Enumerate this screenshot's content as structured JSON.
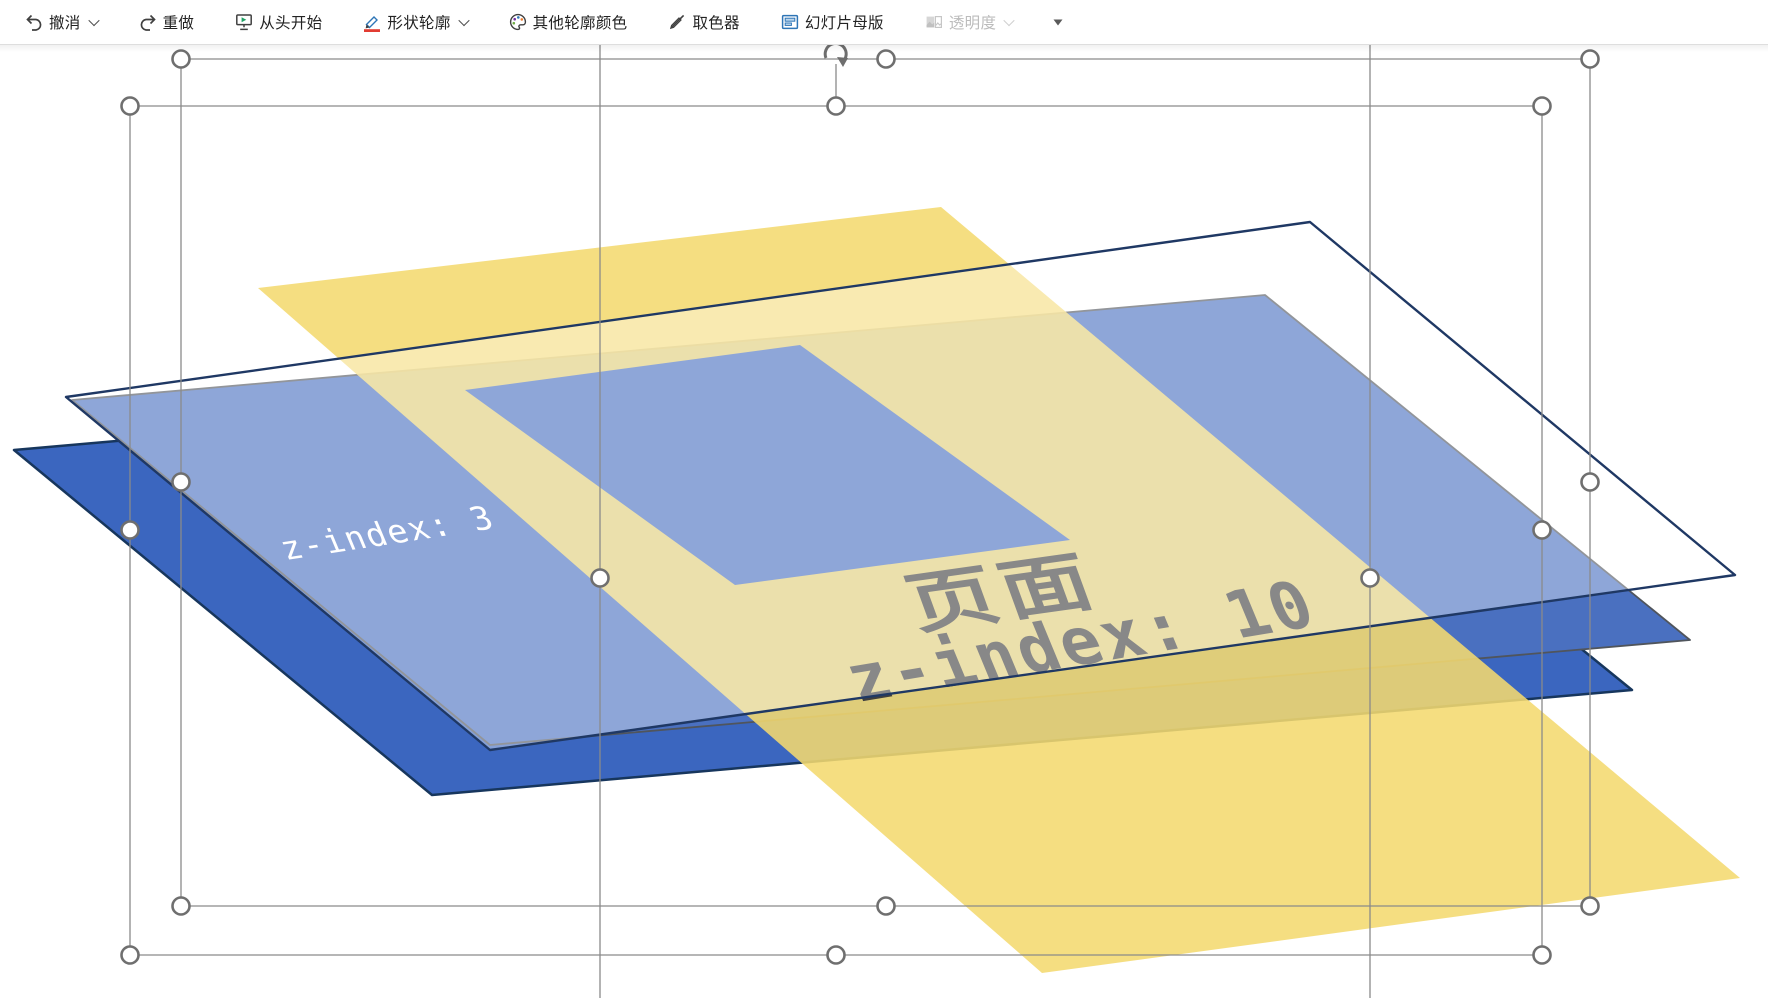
{
  "toolbar": {
    "items": [
      {
        "label": "撤消",
        "icon": "undo-icon",
        "dropdown": true,
        "disabled": false
      },
      {
        "label": "重做",
        "icon": "redo-icon",
        "dropdown": false,
        "disabled": false
      },
      {
        "label": "从头开始",
        "icon": "present-from-start-icon",
        "dropdown": false,
        "disabled": false
      },
      {
        "label": "形状轮廓",
        "icon": "shape-outline-pencil-icon",
        "dropdown": true,
        "disabled": false,
        "accent_color": "#e23c32"
      },
      {
        "label": "其他轮廓颜色",
        "icon": "palette-icon",
        "dropdown": false,
        "disabled": false
      },
      {
        "label": "取色器",
        "icon": "eyedropper-icon",
        "dropdown": false,
        "disabled": false
      },
      {
        "label": "幻灯片母版",
        "icon": "slide-master-icon",
        "dropdown": false,
        "disabled": false
      },
      {
        "label": "透明度",
        "icon": "transparency-icon",
        "dropdown": true,
        "disabled": true
      }
    ],
    "overflow_icon": "ribbon-overflow-icon"
  },
  "canvas": {
    "labels": {
      "blue_page_label": "z-index: 3",
      "yellow_page_title": "页面",
      "yellow_page_label": "z-index: 10"
    },
    "colors": {
      "dark_page_fill": "#3b66bf",
      "dark_page_stroke": "#17365d",
      "light_page_fill": "#4a70c0",
      "light_page_stroke": "#50555c",
      "yellow_fill": "#f4d96f",
      "sheet_fill": "#ffffff",
      "sheet_stroke": "#1f3864",
      "label_on_blue": "#ffffff",
      "label_on_yellow": "#3f3f3f",
      "selection_line": "#8a8a8a",
      "handle_fill": "#ffffff",
      "handle_stroke": "#6f6f6f",
      "rotate_handle": "#6e6e6e"
    }
  }
}
